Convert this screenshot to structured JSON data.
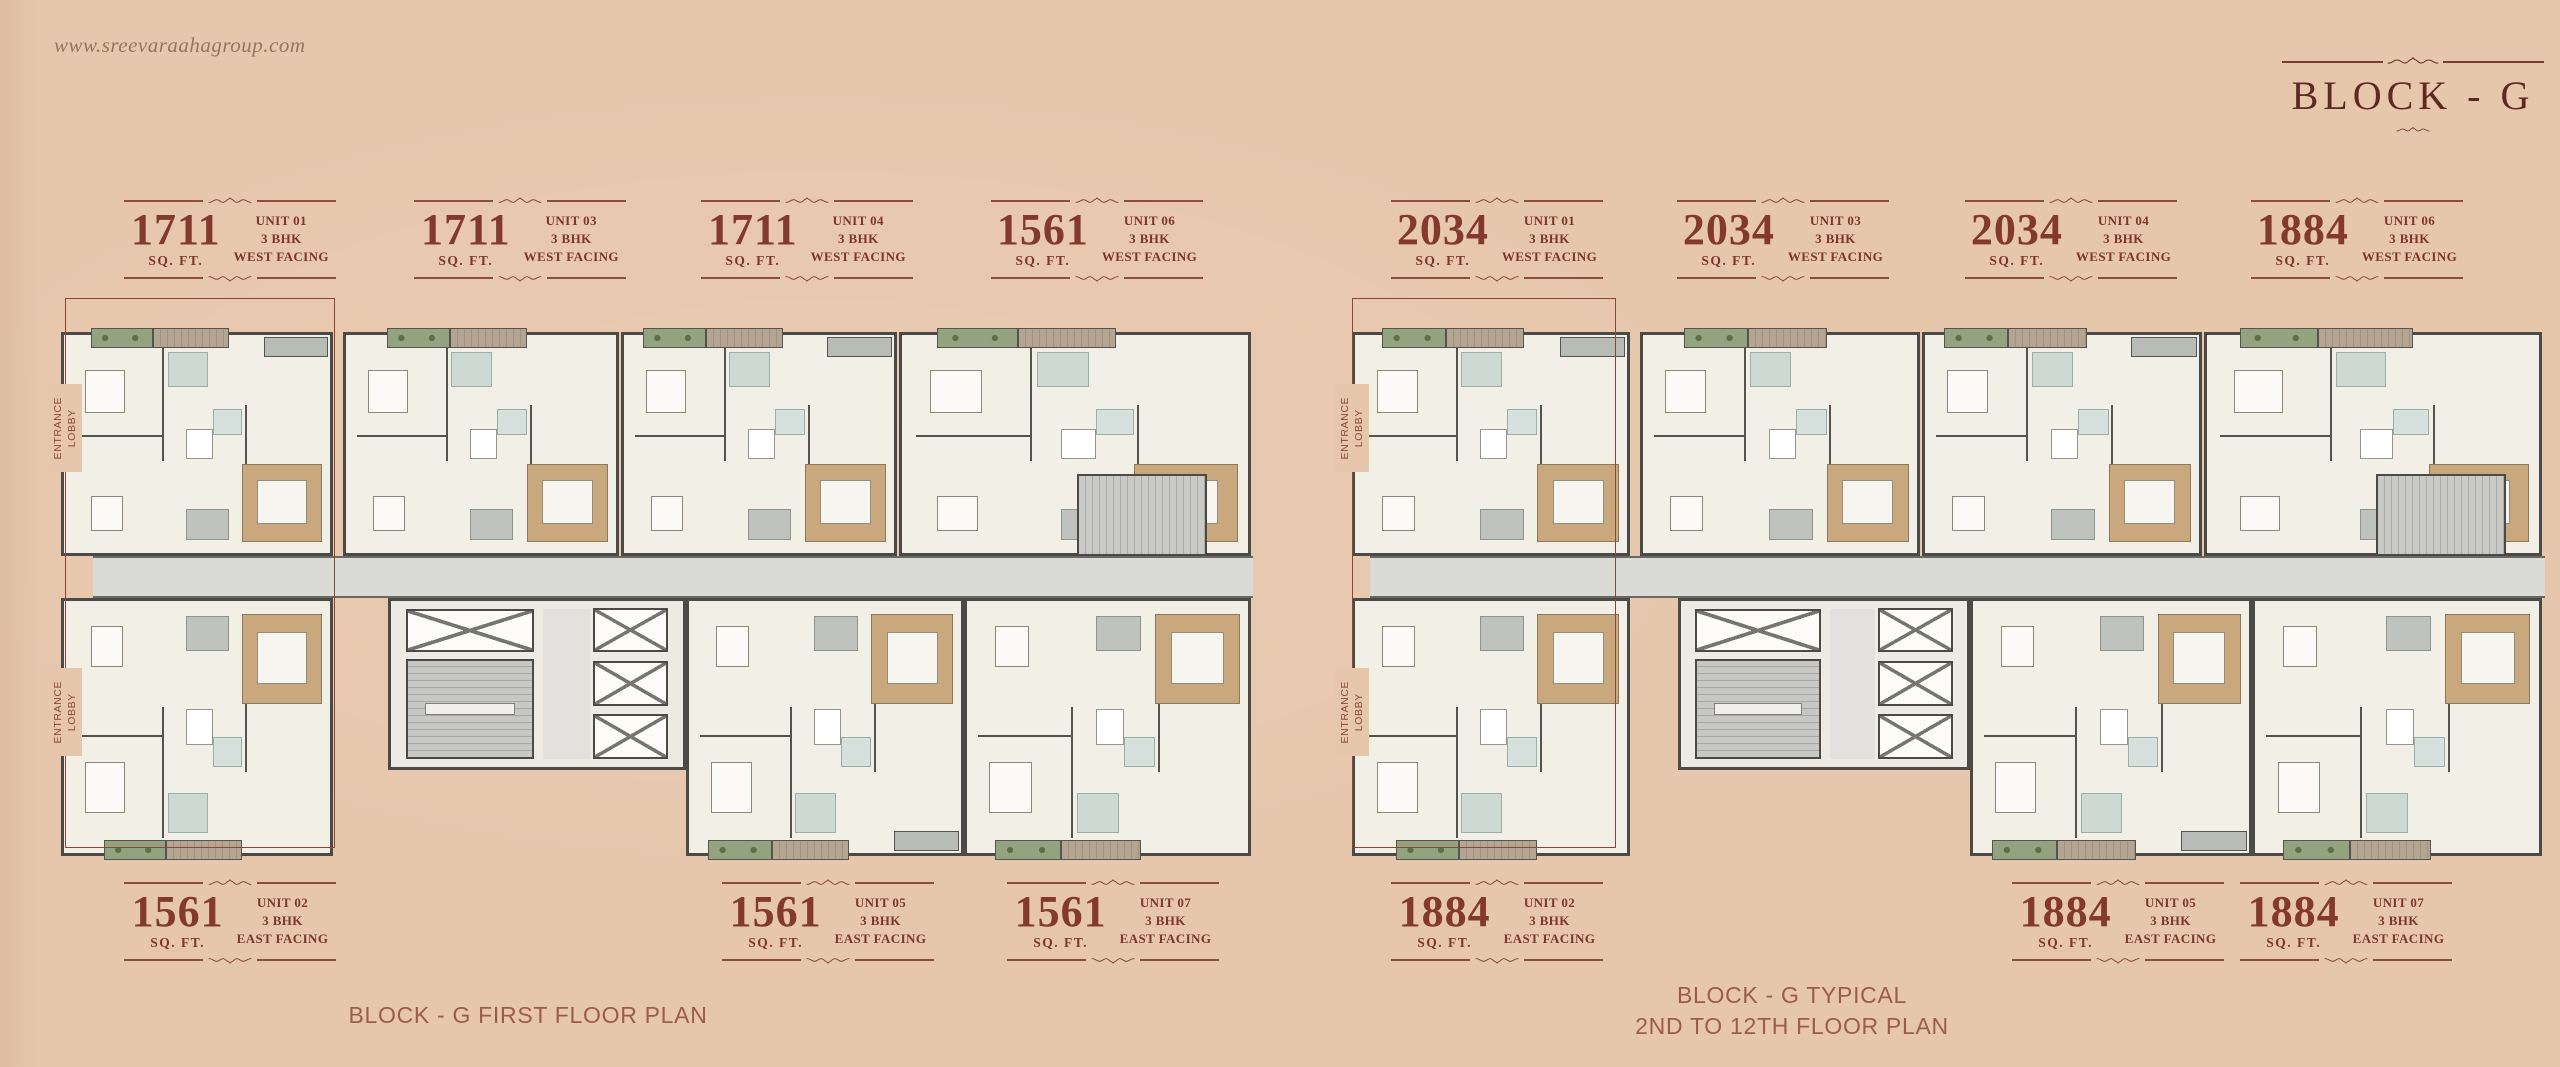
{
  "header": {
    "website": "www.sreevaraahagroup.com",
    "title": "BLOCK - G"
  },
  "colors": {
    "background": "#e7c7ac",
    "accent_maroon": "#7e362b",
    "title_color": "#5e2823",
    "caption_color": "#9c5c4b",
    "highlight_outline": "#8d4536"
  },
  "plans": [
    {
      "name": "first-floor-plan",
      "caption_lines": [
        "BLOCK - G FIRST FLOOR PLAN"
      ],
      "entrance_lobby_label": "ENTRANCE LOBBY",
      "top_units": [
        {
          "area": "1711",
          "area_unit": "SQ. FT.",
          "unit_no": "UNIT 01",
          "bhk": "3 BHK",
          "facing": "WEST FACING"
        },
        {
          "area": "1711",
          "area_unit": "SQ. FT.",
          "unit_no": "UNIT 03",
          "bhk": "3 BHK",
          "facing": "WEST FACING"
        },
        {
          "area": "1711",
          "area_unit": "SQ. FT.",
          "unit_no": "UNIT 04",
          "bhk": "3 BHK",
          "facing": "WEST FACING"
        },
        {
          "area": "1561",
          "area_unit": "SQ. FT.",
          "unit_no": "UNIT 06",
          "bhk": "3 BHK",
          "facing": "WEST FACING"
        }
      ],
      "bottom_units": [
        {
          "area": "1561",
          "area_unit": "SQ. FT.",
          "unit_no": "UNIT 02",
          "bhk": "3 BHK",
          "facing": "EAST FACING"
        },
        {
          "area": "1561",
          "area_unit": "SQ. FT.",
          "unit_no": "UNIT 05",
          "bhk": "3 BHK",
          "facing": "EAST FACING"
        },
        {
          "area": "1561",
          "area_unit": "SQ. FT.",
          "unit_no": "UNIT 07",
          "bhk": "3 BHK",
          "facing": "EAST FACING"
        }
      ]
    },
    {
      "name": "typical-floor-plan",
      "caption_lines": [
        "BLOCK - G TYPICAL",
        "2ND TO 12TH FLOOR PLAN"
      ],
      "entrance_lobby_label": "ENTRANCE LOBBY",
      "top_units": [
        {
          "area": "2034",
          "area_unit": "SQ. FT.",
          "unit_no": "UNIT 01",
          "bhk": "3 BHK",
          "facing": "WEST FACING"
        },
        {
          "area": "2034",
          "area_unit": "SQ. FT.",
          "unit_no": "UNIT 03",
          "bhk": "3 BHK",
          "facing": "WEST FACING"
        },
        {
          "area": "2034",
          "area_unit": "SQ. FT.",
          "unit_no": "UNIT 04",
          "bhk": "3 BHK",
          "facing": "WEST FACING"
        },
        {
          "area": "1884",
          "area_unit": "SQ. FT.",
          "unit_no": "UNIT 06",
          "bhk": "3 BHK",
          "facing": "WEST FACING"
        }
      ],
      "bottom_units": [
        {
          "area": "1884",
          "area_unit": "SQ. FT.",
          "unit_no": "UNIT 02",
          "bhk": "3 BHK",
          "facing": "EAST FACING"
        },
        {
          "area": "1884",
          "area_unit": "SQ. FT.",
          "unit_no": "UNIT 05",
          "bhk": "3 BHK",
          "facing": "EAST FACING"
        },
        {
          "area": "1884",
          "area_unit": "SQ. FT.",
          "unit_no": "UNIT 07",
          "bhk": "3 BHK",
          "facing": "EAST FACING"
        }
      ]
    }
  ]
}
